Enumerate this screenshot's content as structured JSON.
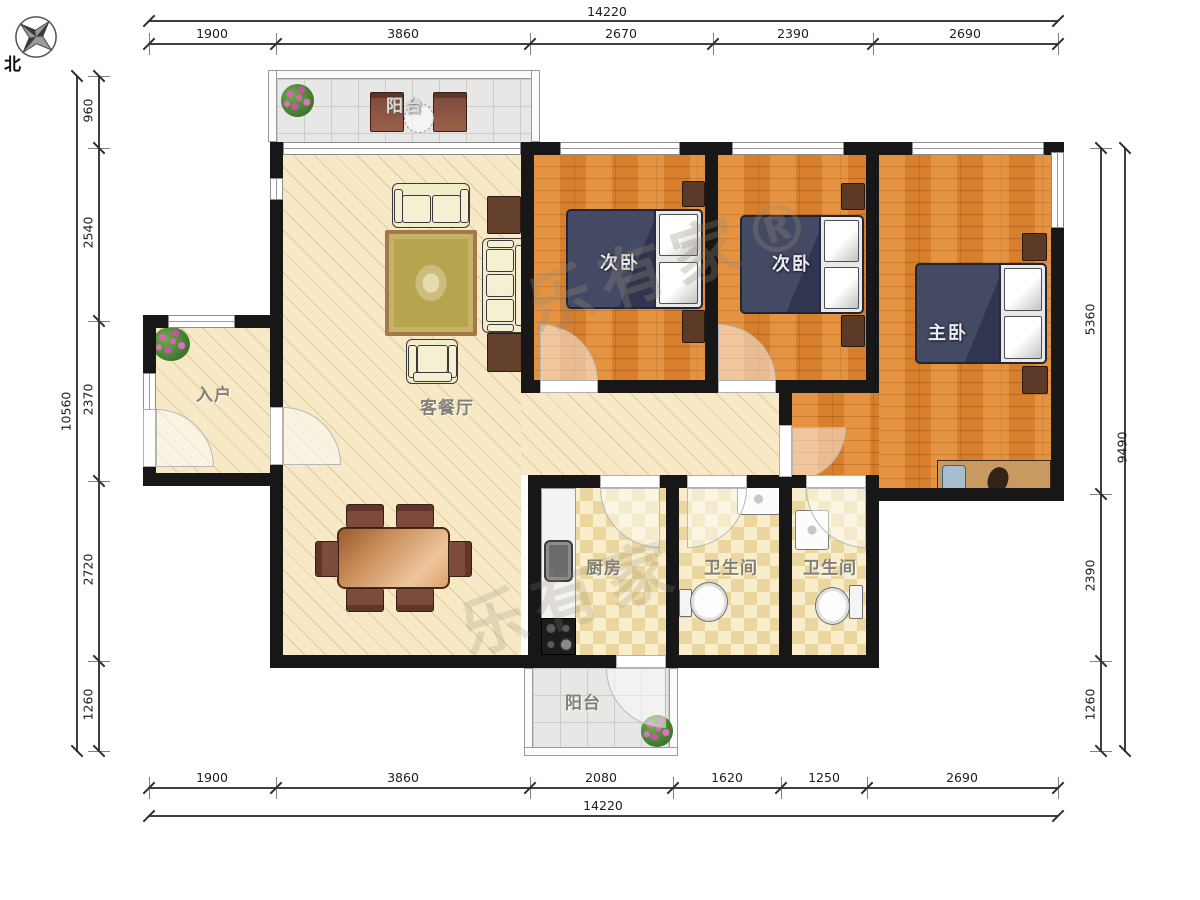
{
  "compass": {
    "north": "北"
  },
  "watermarks": {
    "wm1": "乐有家®",
    "wm2": "乐有家"
  },
  "rooms": {
    "balcony_top": "阳台",
    "bedroom_a": "次卧",
    "bedroom_b": "次卧",
    "master_bedroom": "主卧",
    "entry": "入户",
    "living_dining": "客餐厅",
    "kitchen": "厨房",
    "bathroom_a": "卫生间",
    "bathroom_b": "卫生间",
    "balcony_bottom": "阳台"
  },
  "dimensions": {
    "top": {
      "total": "14220",
      "segments": [
        "1900",
        "3860",
        "2670",
        "2390",
        "2690"
      ]
    },
    "bottom": {
      "total": "14220",
      "segments": [
        "1900",
        "3860",
        "2080",
        "1620",
        "1250",
        "2690"
      ]
    },
    "left": {
      "total": "10560",
      "segments": [
        "960",
        "2540",
        "2370",
        "2720",
        "1260"
      ]
    },
    "right": {
      "total": "9490",
      "segments": [
        "5360",
        "2390",
        "1260"
      ]
    }
  },
  "colors": {
    "wall": "#171717",
    "wood_floor": "#e0852f",
    "cream_floor": "#f7e9c6",
    "tile_floor": "#f8eecb",
    "balcony_floor": "#e7e7e5",
    "bed": "#3e4459"
  }
}
